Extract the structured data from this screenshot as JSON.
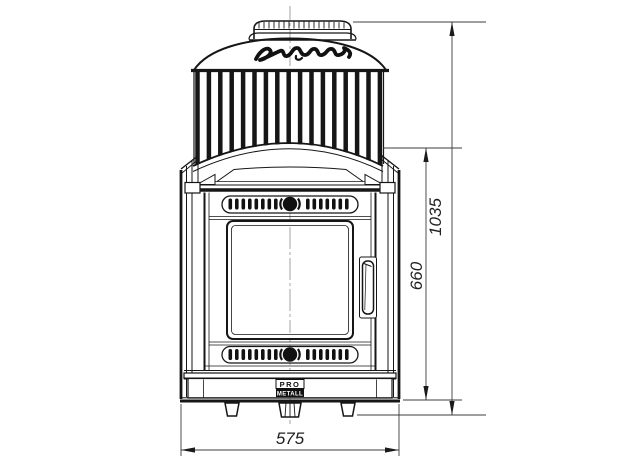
{
  "drawing": {
    "script_logo": "Атмосфера",
    "brand": {
      "top": "PRO",
      "bottom": "METALL"
    },
    "dimensions": {
      "overall_height_mm": "1035",
      "firebox_height_mm": "660",
      "width_mm": "575"
    },
    "colors": {
      "ink": "#161616",
      "dimension_line": "#3c3c3c",
      "centerline": "#8c8c8c",
      "background": "#ffffff"
    }
  }
}
